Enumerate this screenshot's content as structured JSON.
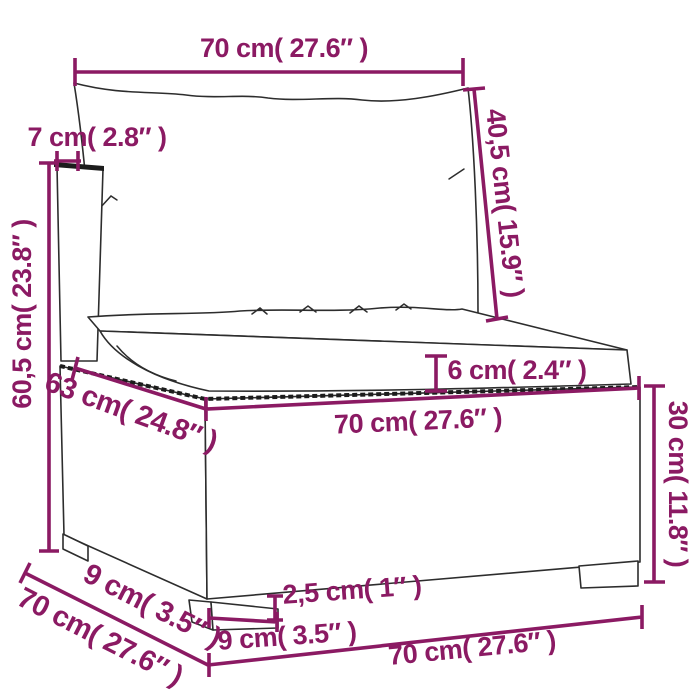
{
  "figure": {
    "kind": "product dimension diagram",
    "subject": "poly rattan garden sofa middle section with back cushion and seat cushion"
  },
  "colors": {
    "dimension_accent": "#8B1A63",
    "line_art": "#2d2d2d",
    "background": "#ffffff"
  },
  "dimensions": {
    "back_cushion_width": "70 cm( 27.6″ )",
    "back_panel_thickness": "7 cm( 2.8″ )",
    "total_height": "60,5 cm( 23.8″ )",
    "back_cushion_height": "40,5 cm( 15.9″ )",
    "seat_cushion_thickness": "6 cm( 2.4″ )",
    "seat_depth": "63 cm( 24.8″ )",
    "seat_front_width": "70 cm( 27.6″ )",
    "base_height": "30 cm( 11.8″ )",
    "foot_depth": "9 cm( 3.5″ )",
    "total_depth": "70 cm( 27.6″ )",
    "leg_height": "2,5 cm( 1″ )",
    "foot_width": "9 cm( 3.5″ )",
    "base_bottom_width": "70 cm( 27.6″ )"
  }
}
